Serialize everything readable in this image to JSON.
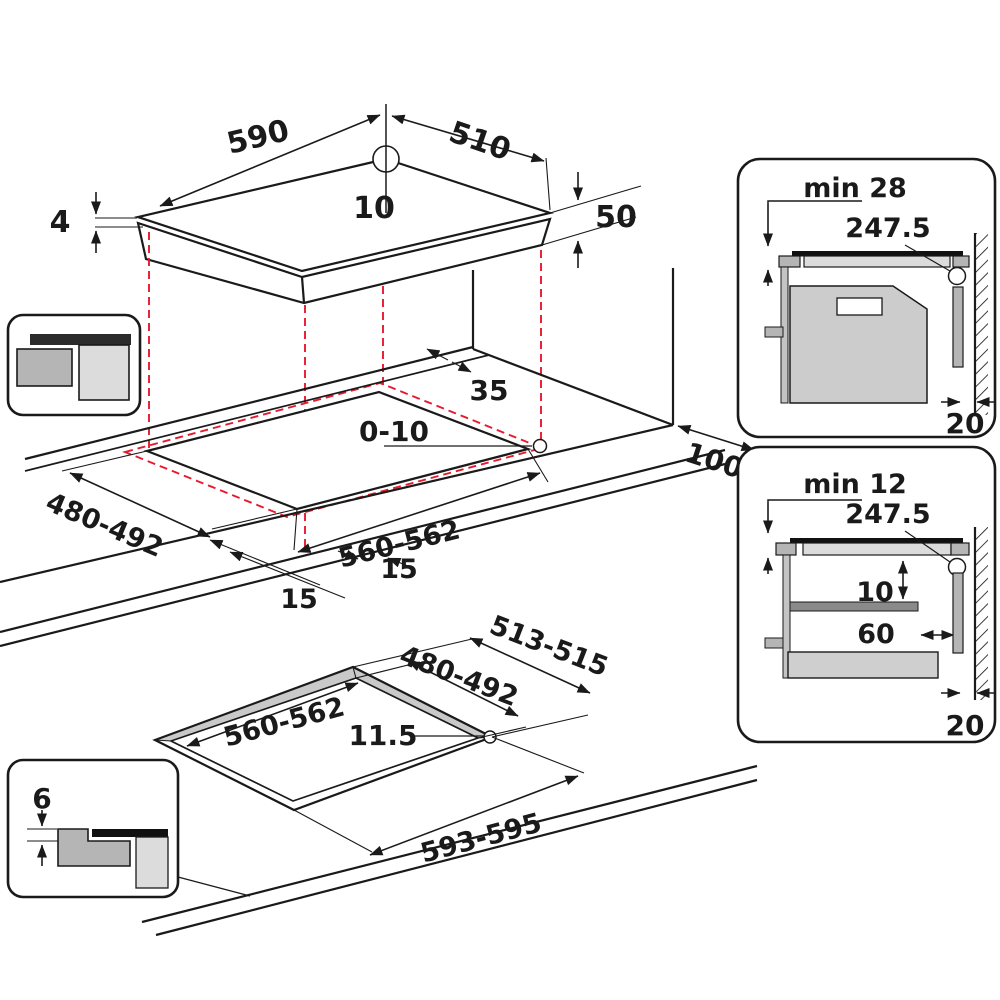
{
  "colors": {
    "line": "#1a1a1a",
    "projection_red": "#e8192c",
    "glass_black": "#111111",
    "gray_light": "#dcdcdc",
    "gray_mid": "#b5b5b5",
    "gray_dark": "#8a8a8a"
  },
  "top_view": {
    "width": "590",
    "depth": "510",
    "rear_center_offset": "10",
    "glass_thickness": "4",
    "build_in_height": "50"
  },
  "cutout_view": {
    "rear_clearance": "35",
    "edge_gap": "0-10",
    "cutout_depth": "480-492",
    "cutout_width": "560-562",
    "overhang_side": "15",
    "overhang_front": "15",
    "side_wall_clearance": "100"
  },
  "flush_view": {
    "outer_depth": "513-515",
    "inner_depth": "480-492",
    "inner_width": "560-562",
    "corner_radius": "11.5",
    "outer_width": "593-595"
  },
  "flush_inset": {
    "rebate_depth": "6"
  },
  "panel_oven": {
    "min_clearance": "min 28",
    "cable_length": "247.5",
    "rear_gap": "20"
  },
  "panel_drawer": {
    "min_clearance": "min 12",
    "cable_length": "247.5",
    "shelf_clearance": "10",
    "shelf_setback": "60",
    "rear_gap": "20"
  }
}
